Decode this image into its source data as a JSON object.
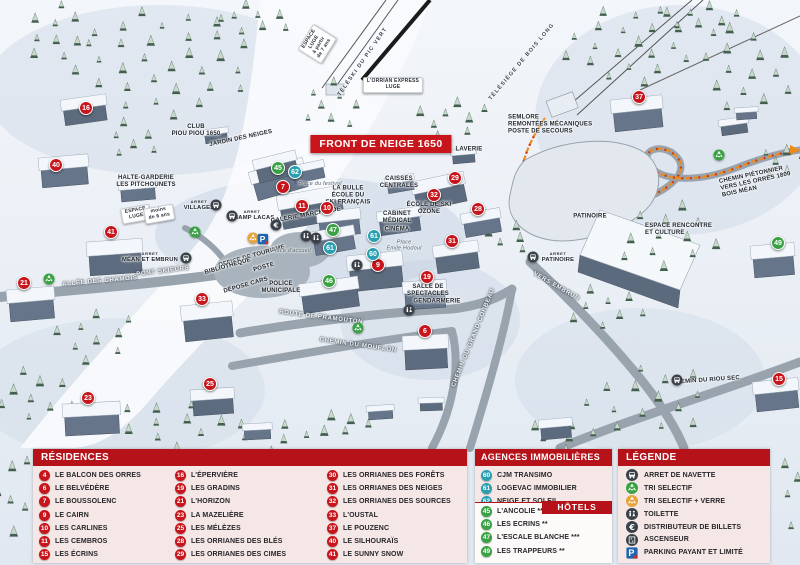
{
  "map": {
    "banner": "FRONT DE NEIGE 1650",
    "arret_prefix": "ARRET",
    "markers": [
      {
        "num": "16",
        "type": "residence",
        "x": 86,
        "y": 108
      },
      {
        "num": "40",
        "type": "residence",
        "x": 56,
        "y": 165
      },
      {
        "num": "41",
        "type": "residence",
        "x": 111,
        "y": 232
      },
      {
        "num": "21",
        "type": "residence",
        "x": 24,
        "y": 283
      },
      {
        "num": "33",
        "type": "residence",
        "x": 202,
        "y": 299
      },
      {
        "num": "23",
        "type": "residence",
        "x": 88,
        "y": 398
      },
      {
        "num": "25",
        "type": "residence",
        "x": 210,
        "y": 384
      },
      {
        "num": "7",
        "type": "residence",
        "x": 283,
        "y": 187
      },
      {
        "num": "11",
        "type": "residence",
        "x": 302,
        "y": 206
      },
      {
        "num": "10",
        "type": "residence",
        "x": 327,
        "y": 208
      },
      {
        "num": "29",
        "type": "residence",
        "x": 455,
        "y": 178
      },
      {
        "num": "32",
        "type": "residence",
        "x": 434,
        "y": 195
      },
      {
        "num": "28",
        "type": "residence",
        "x": 478,
        "y": 209
      },
      {
        "num": "31",
        "type": "residence",
        "x": 452,
        "y": 241
      },
      {
        "num": "37",
        "type": "residence",
        "x": 639,
        "y": 97
      },
      {
        "num": "9",
        "type": "residence",
        "x": 378,
        "y": 265
      },
      {
        "num": "19",
        "type": "residence",
        "x": 427,
        "y": 277
      },
      {
        "num": "6",
        "type": "residence",
        "x": 425,
        "y": 331
      },
      {
        "num": "15",
        "type": "residence",
        "x": 779,
        "y": 379
      },
      {
        "num": "62",
        "type": "agency",
        "x": 295,
        "y": 172
      },
      {
        "num": "61",
        "type": "agency",
        "x": 374,
        "y": 236
      },
      {
        "num": "61",
        "type": "agency",
        "x": 330,
        "y": 248
      },
      {
        "num": "60",
        "type": "agency",
        "x": 373,
        "y": 254
      },
      {
        "num": "45",
        "type": "hotel",
        "x": 278,
        "y": 168
      },
      {
        "num": "47",
        "type": "hotel",
        "x": 333,
        "y": 230
      },
      {
        "num": "46",
        "type": "hotel",
        "x": 329,
        "y": 281
      },
      {
        "num": "49",
        "type": "hotel",
        "x": 778,
        "y": 243
      }
    ],
    "icons": [
      {
        "icon": "bus",
        "x": 216,
        "y": 205
      },
      {
        "icon": "bus",
        "x": 232,
        "y": 216
      },
      {
        "icon": "bus",
        "x": 186,
        "y": 258
      },
      {
        "icon": "bus",
        "x": 533,
        "y": 257
      },
      {
        "icon": "bus",
        "x": 677,
        "y": 380
      },
      {
        "icon": "recycle-green",
        "x": 195,
        "y": 232
      },
      {
        "icon": "recycle-green",
        "x": 49,
        "y": 279
      },
      {
        "icon": "recycle-green",
        "x": 358,
        "y": 328
      },
      {
        "icon": "recycle-green",
        "x": 719,
        "y": 155
      },
      {
        "icon": "recycle-yellow",
        "x": 253,
        "y": 238
      },
      {
        "icon": "parking",
        "x": 263,
        "y": 239
      },
      {
        "icon": "euro",
        "x": 276,
        "y": 225
      },
      {
        "icon": "toilet",
        "x": 306,
        "y": 236
      },
      {
        "icon": "toilet",
        "x": 316,
        "y": 238
      },
      {
        "icon": "toilet",
        "x": 409,
        "y": 310
      },
      {
        "icon": "toilet",
        "x": 357,
        "y": 265
      }
    ],
    "labels": [
      {
        "t": "ESPACE\nLUGE\nà partir\nde 7 ans",
        "x": 317,
        "y": 44,
        "r": -58,
        "k": "sign"
      },
      {
        "t": "TÉLÉSKI DU PIC VERT",
        "x": 363,
        "y": 62,
        "r": -55,
        "k": "lift"
      },
      {
        "t": "L'ORRIAN EXPRESS\nLUGE",
        "x": 393,
        "y": 85,
        "r": 0,
        "k": "sign"
      },
      {
        "t": "TÉLÉSIÈGE DE BOIS LONG",
        "x": 522,
        "y": 62,
        "r": -50,
        "k": "lift"
      },
      {
        "t": "SEMLORE\nREMONTÉES MÉCANIQUES\nPOSTE DE SECOURS",
        "x": 508,
        "y": 125,
        "r": 0,
        "k": "left"
      },
      {
        "t": "LAVERIE",
        "x": 469,
        "y": 150,
        "r": 0,
        "k": "plain"
      },
      {
        "t": "CAISSES\nCENTRALES",
        "x": 399,
        "y": 183,
        "r": 0,
        "k": "plain"
      },
      {
        "t": "CLUB\nPIOU PIOU 1650",
        "x": 196,
        "y": 131,
        "r": 0,
        "k": "plain"
      },
      {
        "t": "JARDIN DES NEIGES",
        "x": 241,
        "y": 139,
        "r": -12,
        "k": "plain"
      },
      {
        "t": "HALTE-GARDERIE\nLES PITCHOUNETS",
        "x": 146,
        "y": 182,
        "r": 0,
        "k": "plain"
      },
      {
        "t": "ESPACE\nLUGE",
        "x": 136,
        "y": 214,
        "r": -10,
        "k": "sign"
      },
      {
        "t": "moins\nde 6 ans",
        "x": 159,
        "y": 214,
        "r": -10,
        "k": "sign"
      },
      {
        "t": "VILLAGES",
        "x": 199,
        "y": 206,
        "r": 0,
        "k": "arret"
      },
      {
        "t": "CHAMP LACAS",
        "x": 252,
        "y": 216,
        "r": 0,
        "k": "arret"
      },
      {
        "t": "Place du festival",
        "x": 320,
        "y": 184,
        "r": 0,
        "k": "place"
      },
      {
        "t": "LA BULLE\nÉCOLE DU\nSKI FRANÇAIS",
        "x": 348,
        "y": 196,
        "r": 0,
        "k": "plain"
      },
      {
        "t": "GALERIE MARCHANDE",
        "x": 306,
        "y": 216,
        "r": -10,
        "k": "plain"
      },
      {
        "t": "ÉCOLE DE SKI\nOZONE",
        "x": 429,
        "y": 209,
        "r": 0,
        "k": "plain"
      },
      {
        "t": "CABINET\nMÉDICAL",
        "x": 397,
        "y": 218,
        "r": 0,
        "k": "plain"
      },
      {
        "t": "CINÉMA",
        "x": 397,
        "y": 230,
        "r": 0,
        "k": "plain"
      },
      {
        "t": "Place\nÉmile Hodoul",
        "x": 404,
        "y": 246,
        "r": 0,
        "k": "place"
      },
      {
        "t": "MÉAN ET EMBRUN",
        "x": 150,
        "y": 258,
        "r": 0,
        "k": "arret"
      },
      {
        "t": "OFFICE DE TOURISME",
        "x": 252,
        "y": 257,
        "r": -16,
        "k": "plain"
      },
      {
        "t": "POSTE",
        "x": 264,
        "y": 268,
        "r": -16,
        "k": "plain"
      },
      {
        "t": "BIBLIOTHÈQUE",
        "x": 228,
        "y": 267,
        "r": -16,
        "k": "plain"
      },
      {
        "t": "DÉPOSE CARS",
        "x": 246,
        "y": 286,
        "r": -16,
        "k": "plain"
      },
      {
        "t": "POLICE\nMUNICIPALE",
        "x": 281,
        "y": 288,
        "r": 0,
        "k": "plain"
      },
      {
        "t": "Place d'accueil",
        "x": 291,
        "y": 251,
        "r": 0,
        "k": "place"
      },
      {
        "t": "PONT SKIEURS",
        "x": 163,
        "y": 272,
        "r": -7,
        "k": "road"
      },
      {
        "t": "ALLÉE DES CHAMOIS",
        "x": 100,
        "y": 282,
        "r": -5,
        "k": "road"
      },
      {
        "t": "ROUTE DE PRAMOUTON",
        "x": 321,
        "y": 318,
        "r": 7,
        "k": "road"
      },
      {
        "t": "CHEMIN DU MOUFLON",
        "x": 358,
        "y": 346,
        "r": 8,
        "k": "road"
      },
      {
        "t": "CHEMIN DU GRAND CORBEAU",
        "x": 474,
        "y": 338,
        "r": -68,
        "k": "road"
      },
      {
        "t": "VERS EMBRUN",
        "x": 556,
        "y": 287,
        "r": 30,
        "k": "road"
      },
      {
        "t": "PATINOIRE",
        "x": 590,
        "y": 217,
        "r": 0,
        "k": "plain"
      },
      {
        "t": "PATINOIRE",
        "x": 558,
        "y": 258,
        "r": 0,
        "k": "arret"
      },
      {
        "t": "ESPACE RENCONTRE\nET CULTURE",
        "x": 645,
        "y": 230,
        "r": 0,
        "k": "left"
      },
      {
        "t": "CHEMIN PIÉTONNIER\nVERS LES ORRES 1800\nBOIS MÉAN",
        "x": 720,
        "y": 182,
        "r": -12,
        "k": "left"
      },
      {
        "t": "CHEMIN DU RIOU SEC",
        "x": 706,
        "y": 381,
        "r": -4,
        "k": "plain"
      },
      {
        "t": "SALLE DE\nSPECTACLES",
        "x": 428,
        "y": 291,
        "r": 0,
        "k": "plain"
      },
      {
        "t": "GENDARMERIE",
        "x": 437,
        "y": 302,
        "r": 0,
        "k": "plain"
      }
    ]
  },
  "legend": {
    "residences": {
      "title": "RÉSIDENCES",
      "items": [
        {
          "num": "4",
          "label": "LE BALCON DES ORRES"
        },
        {
          "num": "6",
          "label": "LE BELVÉDÈRE"
        },
        {
          "num": "7",
          "label": "LE BOUSSOLENC"
        },
        {
          "num": "9",
          "label": "LE CAIRN"
        },
        {
          "num": "10",
          "label": "LES CARLINES"
        },
        {
          "num": "11",
          "label": "LES CEMBROS"
        },
        {
          "num": "15",
          "label": "LES ÉCRINS"
        },
        {
          "num": "16",
          "label": "L'ÉPERVIÈRE"
        },
        {
          "num": "19",
          "label": "LES GRADINS"
        },
        {
          "num": "21",
          "label": "L'HORIZON"
        },
        {
          "num": "23",
          "label": "LA MAZELIÈRE"
        },
        {
          "num": "25",
          "label": "LES MÉLÈZES"
        },
        {
          "num": "28",
          "label": "LES ORRIANES DES BLÉS"
        },
        {
          "num": "29",
          "label": "LES ORRIANES DES CIMES"
        },
        {
          "num": "30",
          "label": "LES ORRIANES DES FORÊTS"
        },
        {
          "num": "31",
          "label": "LES ORRIANES DES NEIGES"
        },
        {
          "num": "32",
          "label": "LES ORRIANES DES SOURCES"
        },
        {
          "num": "33",
          "label": "L'OUSTAL"
        },
        {
          "num": "37",
          "label": "LE POUZENC"
        },
        {
          "num": "40",
          "label": "LE SILHOURAÏS"
        },
        {
          "num": "41",
          "label": "LE SUNNY SNOW"
        }
      ]
    },
    "agencies": {
      "title": "AGENCES IMMOBILIÈRES",
      "items": [
        {
          "num": "60",
          "label": "CJM TRANSIMO"
        },
        {
          "num": "61",
          "label": "LOGEVAC IMMOBILIER"
        },
        {
          "num": "62",
          "label": "NEIGE ET SOLEIL"
        }
      ]
    },
    "hotels": {
      "title": "HÔTELS",
      "items": [
        {
          "num": "45",
          "label": "L'ANCOLIE **"
        },
        {
          "num": "46",
          "label": "LES ECRINS **"
        },
        {
          "num": "47",
          "label": "L'ESCALE BLANCHE ***"
        },
        {
          "num": "49",
          "label": "LES TRAPPEURS **"
        }
      ]
    },
    "legende": {
      "title": "LÉGENDE",
      "items": [
        {
          "icon": "bus",
          "label": "ARRET DE NAVETTE"
        },
        {
          "icon": "recycle-green",
          "label": "TRI SELECTIF"
        },
        {
          "icon": "recycle-yellow",
          "label": "TRI SELECTIF + VERRE"
        },
        {
          "icon": "toilet",
          "label": "TOILETTE"
        },
        {
          "icon": "euro",
          "label": "DISTRIBUTEUR DE BILLETS"
        },
        {
          "icon": "elevator",
          "label": "ASCENSEUR"
        },
        {
          "icon": "parking",
          "label": "PARKING PAYANT ET LIMITÉ"
        }
      ]
    }
  },
  "colors": {
    "residence": "#c8151c",
    "agency": "#29a0b2",
    "hotel": "#3aa244",
    "header_red": "#b5121a",
    "banner_red": "#c8151c"
  }
}
